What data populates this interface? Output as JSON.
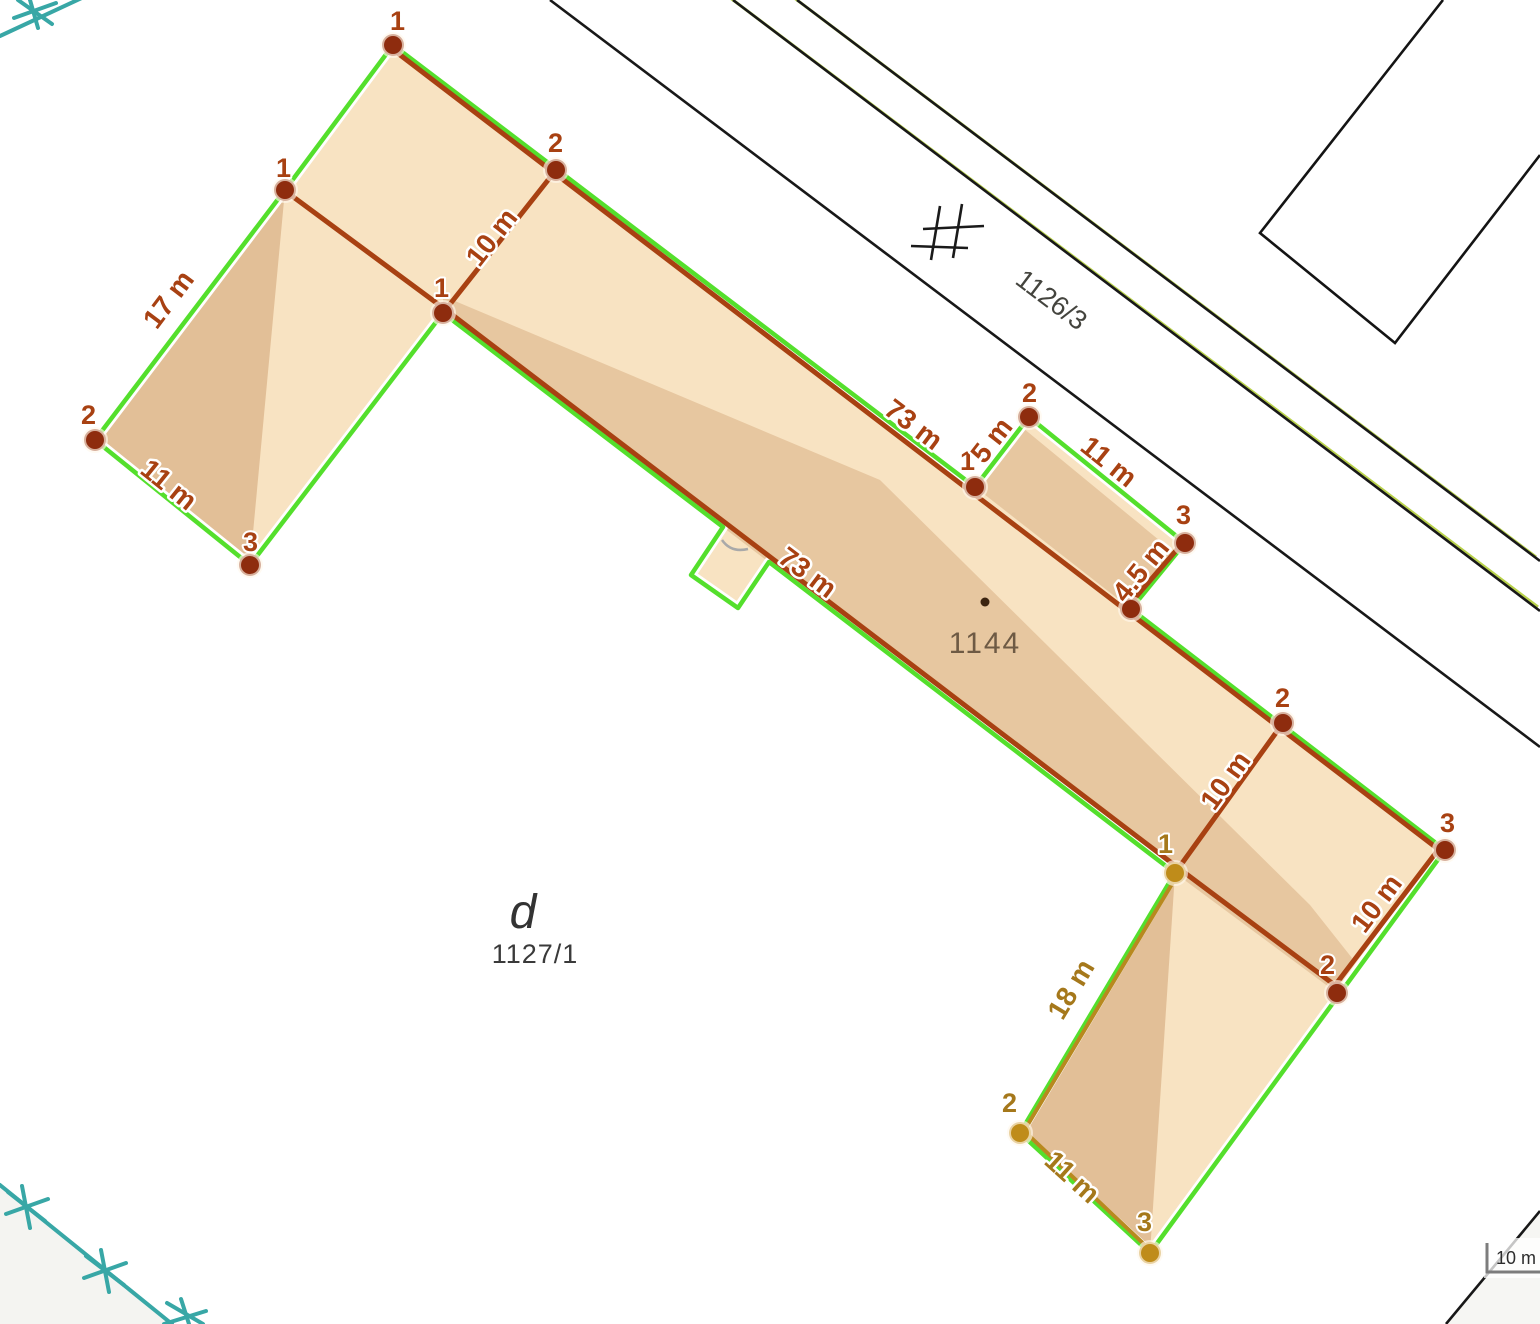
{
  "parcels": {
    "p1126_3": {
      "label": "1126/3"
    },
    "p1144": {
      "label": "1144"
    },
    "p1127_1": {
      "label": "1127/1"
    },
    "sub_d": {
      "label": "d"
    }
  },
  "scalebar": {
    "label": "10 m"
  },
  "vertices": [
    {
      "n": "1",
      "color": "red"
    },
    {
      "n": "2",
      "color": "red"
    },
    {
      "n": "1",
      "color": "red"
    },
    {
      "n": "2",
      "color": "red"
    },
    {
      "n": "3",
      "color": "red"
    },
    {
      "n": "1",
      "color": "red"
    },
    {
      "n": "1",
      "color": "red"
    },
    {
      "n": "2",
      "color": "red"
    },
    {
      "n": "3",
      "color": "red"
    },
    {
      "n": "2",
      "color": "red"
    },
    {
      "n": "3",
      "color": "red"
    },
    {
      "n": "2",
      "color": "red"
    },
    {
      "n": "1",
      "color": "gold"
    },
    {
      "n": "2",
      "color": "gold"
    },
    {
      "n": "3",
      "color": "gold"
    }
  ],
  "measurements": [
    {
      "text": "10 m",
      "color": "red"
    },
    {
      "text": "73 m",
      "color": "red"
    },
    {
      "text": "5 m",
      "color": "red"
    },
    {
      "text": "11 m",
      "color": "red"
    },
    {
      "text": "4.5 m",
      "color": "red"
    },
    {
      "text": "73 m",
      "color": "red"
    },
    {
      "text": "17 m",
      "color": "red"
    },
    {
      "text": "11 m",
      "color": "red"
    },
    {
      "text": "10 m",
      "color": "red"
    },
    {
      "text": "10 m",
      "color": "red"
    },
    {
      "text": "18 m",
      "color": "gold"
    },
    {
      "text": "11 m",
      "color": "gold"
    }
  ],
  "colors": {
    "outline_green": "#54df2c",
    "measure_red": "#a84112",
    "dot_red": "#8e2c0e",
    "measure_gold": "#b8891f",
    "measure_gold_text": "#a5781b",
    "dot_gold": "#bf8c1a",
    "fill_light": "#f8e3c2",
    "fill_dark": "#e7c7a0",
    "fill_wing_dark": "#e2bf97",
    "teal": "#38a7a6",
    "road_green": "#b9d24b",
    "label_gray": "#44443e",
    "parcel_brown": "#6e5a44"
  }
}
